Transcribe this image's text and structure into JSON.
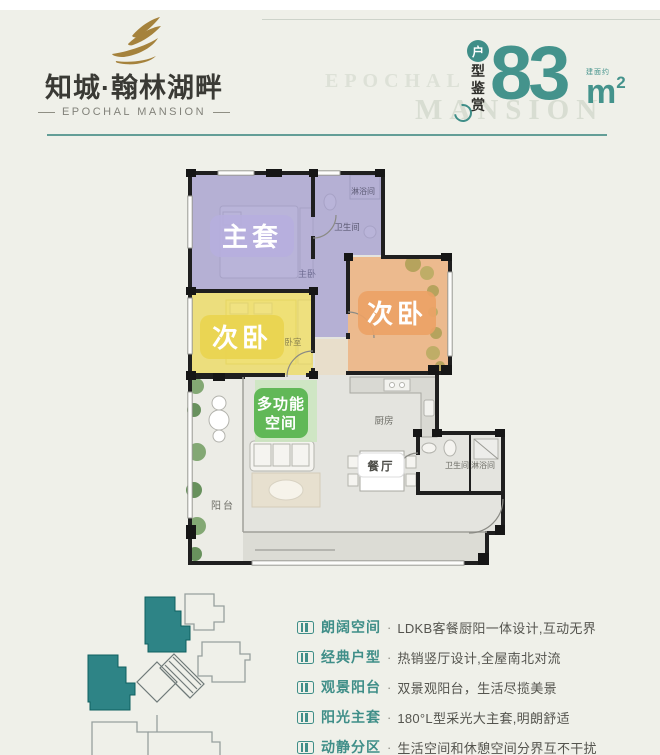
{
  "brand": {
    "title": "知城·翰林湖畔",
    "subtitle": "EPOCHAL MANSION"
  },
  "watermark": {
    "word1": "EPOCHAL",
    "word2": "MANSION"
  },
  "area_tag": {
    "circle_char": "户",
    "char1": "型",
    "char2": "鉴",
    "char3": "赏",
    "value": "83",
    "note": "建面约",
    "unit": "m",
    "sup": "2"
  },
  "colors": {
    "accent_teal": "#3f8e88",
    "gold": "#a5823c",
    "room_master_purple": "#a29bd0",
    "room_bed_yellow": "#eedc62",
    "room_bed_orange": "#efa96f",
    "room_multi_green": "#5bb551",
    "siteplan_teal": "#2e8486"
  },
  "plan": {
    "labels": {
      "master": "主套",
      "bed_left": "次卧",
      "bed_right": "次卧",
      "multi_line1": "多功能",
      "multi_line2": "空间",
      "dining": "餐厅"
    },
    "small": {
      "master_bed": "主卧",
      "bedroom": "卧室",
      "bath_top": "卫生间",
      "shower_top": "淋浴间",
      "kitchen": "厨房",
      "bath_low": "卫生间",
      "shower_low": "淋浴间",
      "balcony": "阳台"
    }
  },
  "features": {
    "separator": "·",
    "items": [
      {
        "label": "朗阔空间",
        "text": "LDKB客餐厨阳一体设计,互动无界"
      },
      {
        "label": "经典户型",
        "text": "热销竖厅设计,全屋南北对流"
      },
      {
        "label": "观景阳台",
        "text": "双景观阳台，生活尽揽美景"
      },
      {
        "label": "阳光主套",
        "text": "180°L型采光大主套,明朗舒适"
      },
      {
        "label": "动静分区",
        "text": "生活空间和休憩空间分界互不干扰"
      }
    ]
  }
}
